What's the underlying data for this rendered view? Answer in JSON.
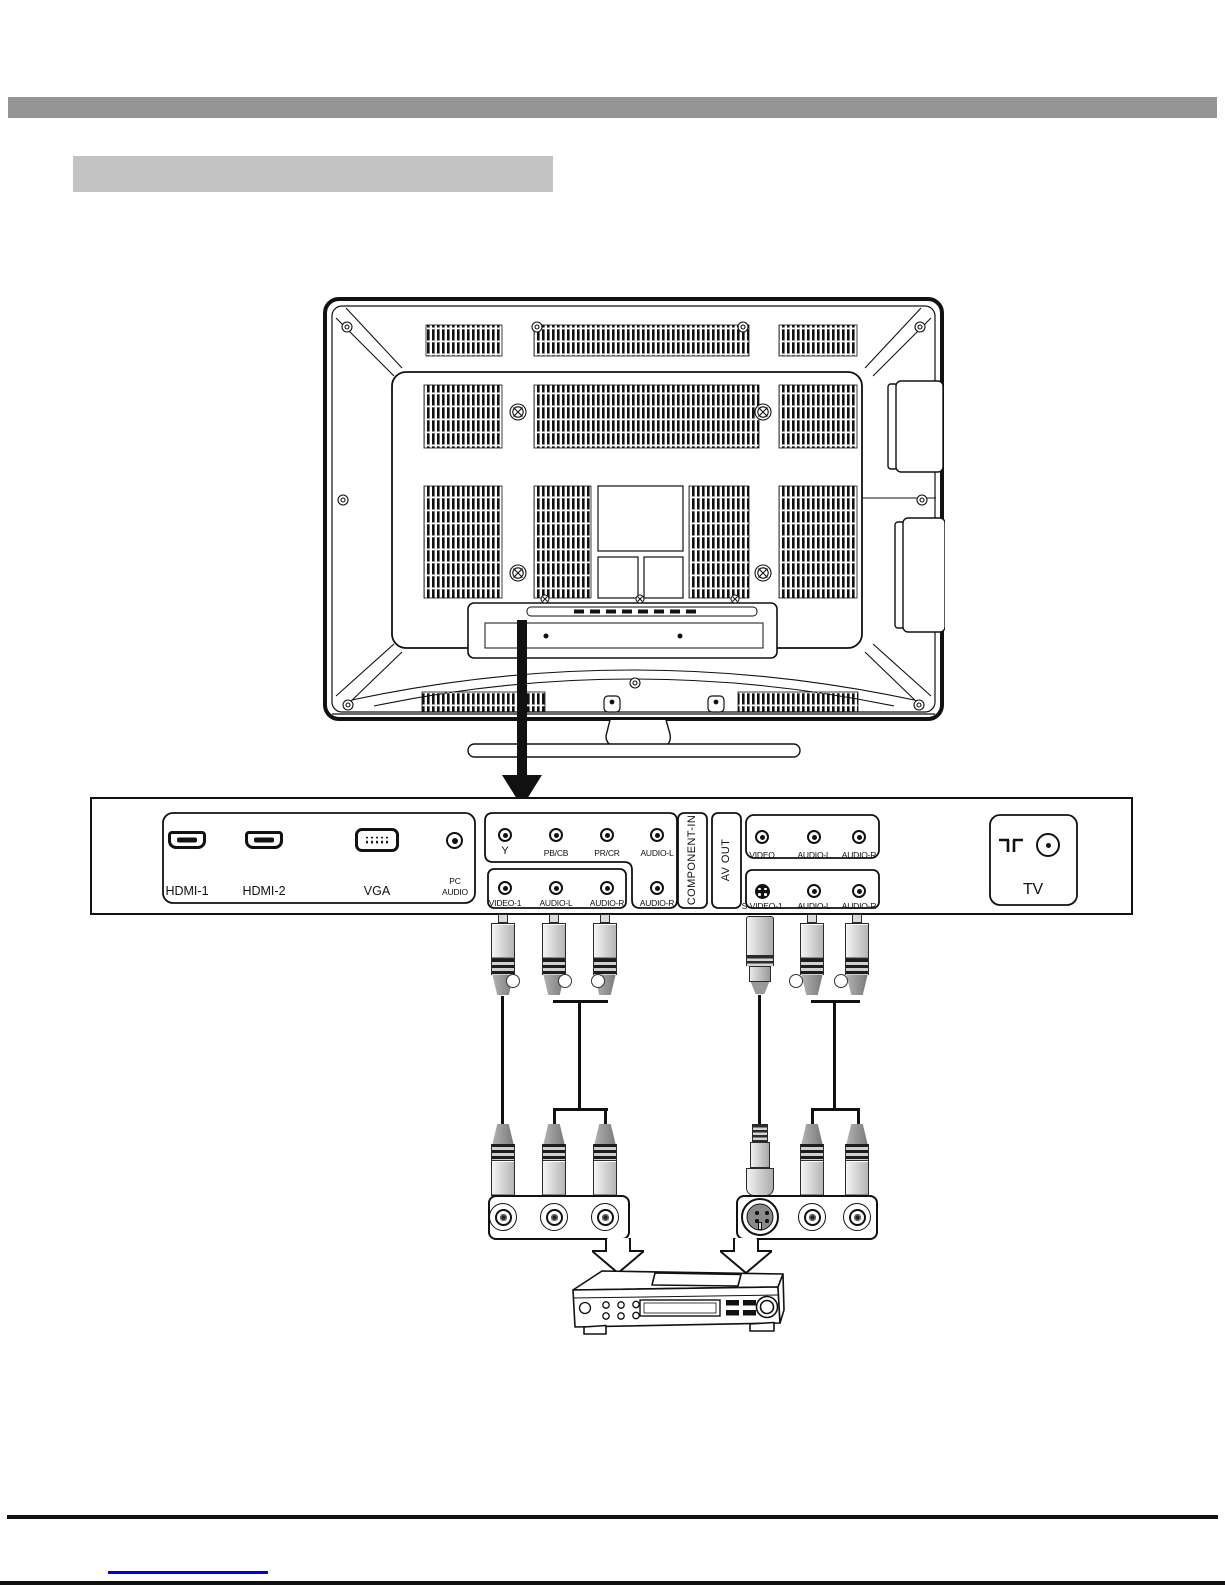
{
  "rear_panel": {
    "pc": {
      "hdmi1": "HDMI-1",
      "hdmi2": "HDMI-2",
      "vga": "VGA",
      "pc_audio_line1": "PC",
      "pc_audio_line2": "AUDIO"
    },
    "component_in": {
      "label": "COMPONENT-IN",
      "top_row": [
        "Y",
        "PB/CB",
        "PR/CR",
        "AUDIO-L"
      ],
      "side_jack": "AUDIO-R",
      "bottom_row": [
        "VIDEO-1",
        "AUDIO-L",
        "AUDIO-R"
      ]
    },
    "av_out": {
      "label": "AV OUT",
      "top_row": [
        "VIDEO",
        "AUDIO-L",
        "AUDIO-R"
      ],
      "bottom_row": [
        "S-VIDEO-1",
        "AUDIO-L",
        "AUDIO-R"
      ]
    },
    "antenna": {
      "label": "TV"
    }
  },
  "colors": {
    "header_bar": "#959595",
    "title_box": "#c3c3c3",
    "ink": "#111111",
    "link_line": "#0000dd"
  }
}
